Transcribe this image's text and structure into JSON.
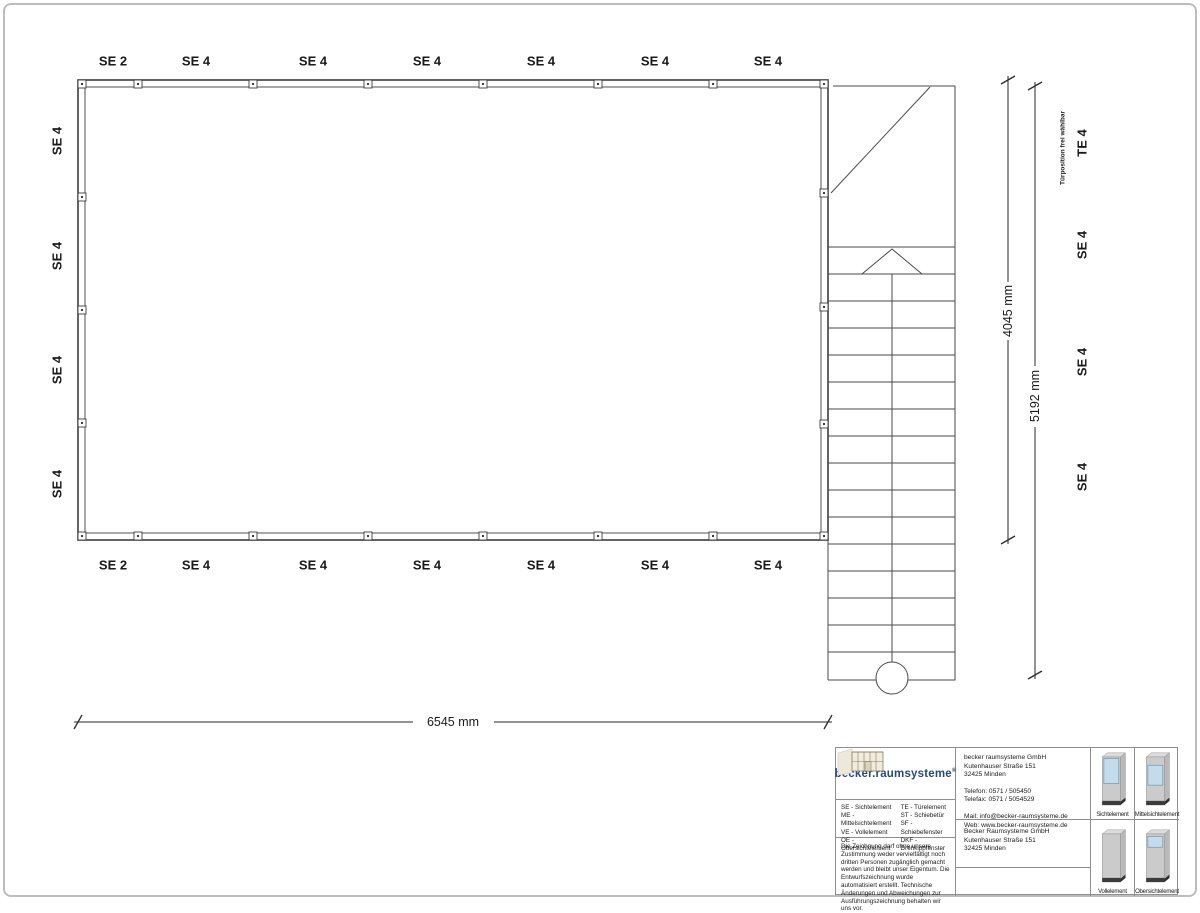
{
  "plan": {
    "top_labels": [
      "SE 2",
      "SE 4",
      "SE 4",
      "SE 4",
      "SE 4",
      "SE 4",
      "SE 4"
    ],
    "bottom_labels": [
      "SE 2",
      "SE 4",
      "SE 4",
      "SE 4",
      "SE 4",
      "SE 4",
      "SE 4"
    ],
    "left_labels": [
      "SE 4",
      "SE 4",
      "SE 4",
      "SE 4"
    ],
    "right_labels": [
      "TE 4",
      "SE 4",
      "SE 4",
      "SE 4"
    ],
    "door_note": "Türposition frei wählbar",
    "dimensions": {
      "width_label": "6545 mm",
      "depth_label": "4045 mm",
      "total_depth_label": "5192 mm"
    }
  },
  "title_block": {
    "logo_text": "becker.raumsysteme",
    "logo_reg": "®",
    "legend": {
      "col1": [
        "SE - Sichtelement",
        "ME - Mittelsichtelement",
        "VE - Vollelement",
        "OE - Obersichtelement"
      ],
      "col2": [
        "TE - Türelement",
        "ST - Schiebetür",
        "SF - Schiebefenster",
        "DKF - Drehkippfenster"
      ]
    },
    "contact": {
      "company": "becker raumsysteme GmbH",
      "street": "Kutenhauser Straße 151",
      "city": "32425 Minden",
      "phone": "Telefon: 0571 / 505450",
      "fax": "Telefax: 0571 / 5054529",
      "mail": "Mail: info@becker-raumsysteme.de",
      "web": "Web: www.becker-raumsysteme.de"
    },
    "address2": {
      "company": "Becker Raumsysteme GmbH",
      "street": "Kutenhauser Straße 151",
      "city": "32425 Minden"
    },
    "disclaimer": "Die Zeichnung darf ohne unsere Zustimmung weder vervielfältigt noch dritten Personen zugänglich gemacht werden und bleibt unser Eigentum. Die Entwurfszeichnung wurde automatisiert erstellt. Technische Änderungen und Abweichungen zur Ausführungszeichnung behalten wir uns vor.",
    "element_types": [
      "Sichtelement",
      "Mittelsichtelement",
      "Vollelement",
      "Obersichtelement"
    ],
    "colors": {
      "logo_blue": "#29497c",
      "glass": "#c4dbeb",
      "panel": "#cbcbcb",
      "base": "#3c3c3c"
    }
  }
}
